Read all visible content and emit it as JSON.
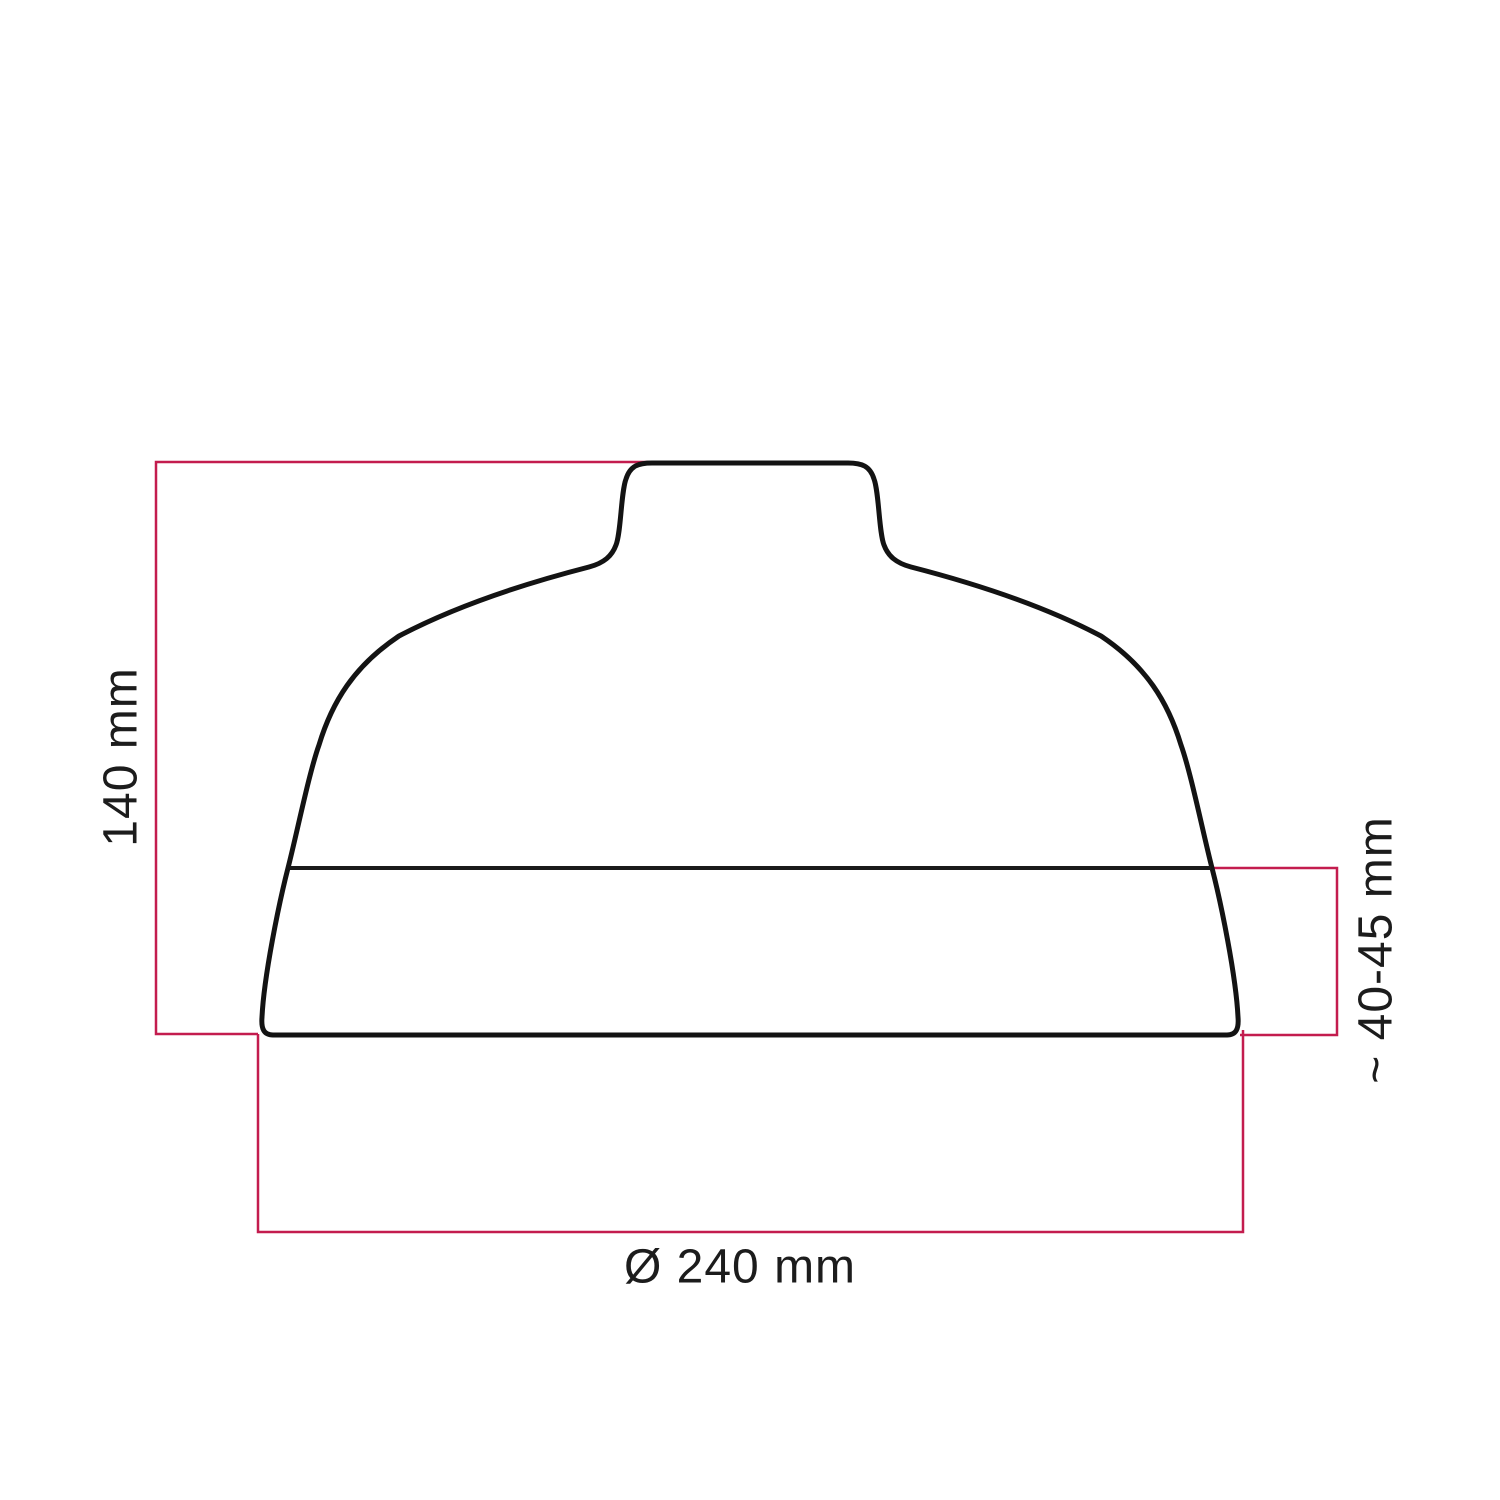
{
  "diagram": {
    "kind": "lampshade-dimension-drawing",
    "labels": {
      "height": "140 mm",
      "diameter": "Ø 240 mm",
      "band_height": "~ 40-45 mm"
    },
    "colors": {
      "outline": "#131313",
      "seam": "#1a1a1a",
      "dimension": "#c31c4e",
      "text": "#1c1c1c",
      "background": "#ffffff"
    }
  }
}
